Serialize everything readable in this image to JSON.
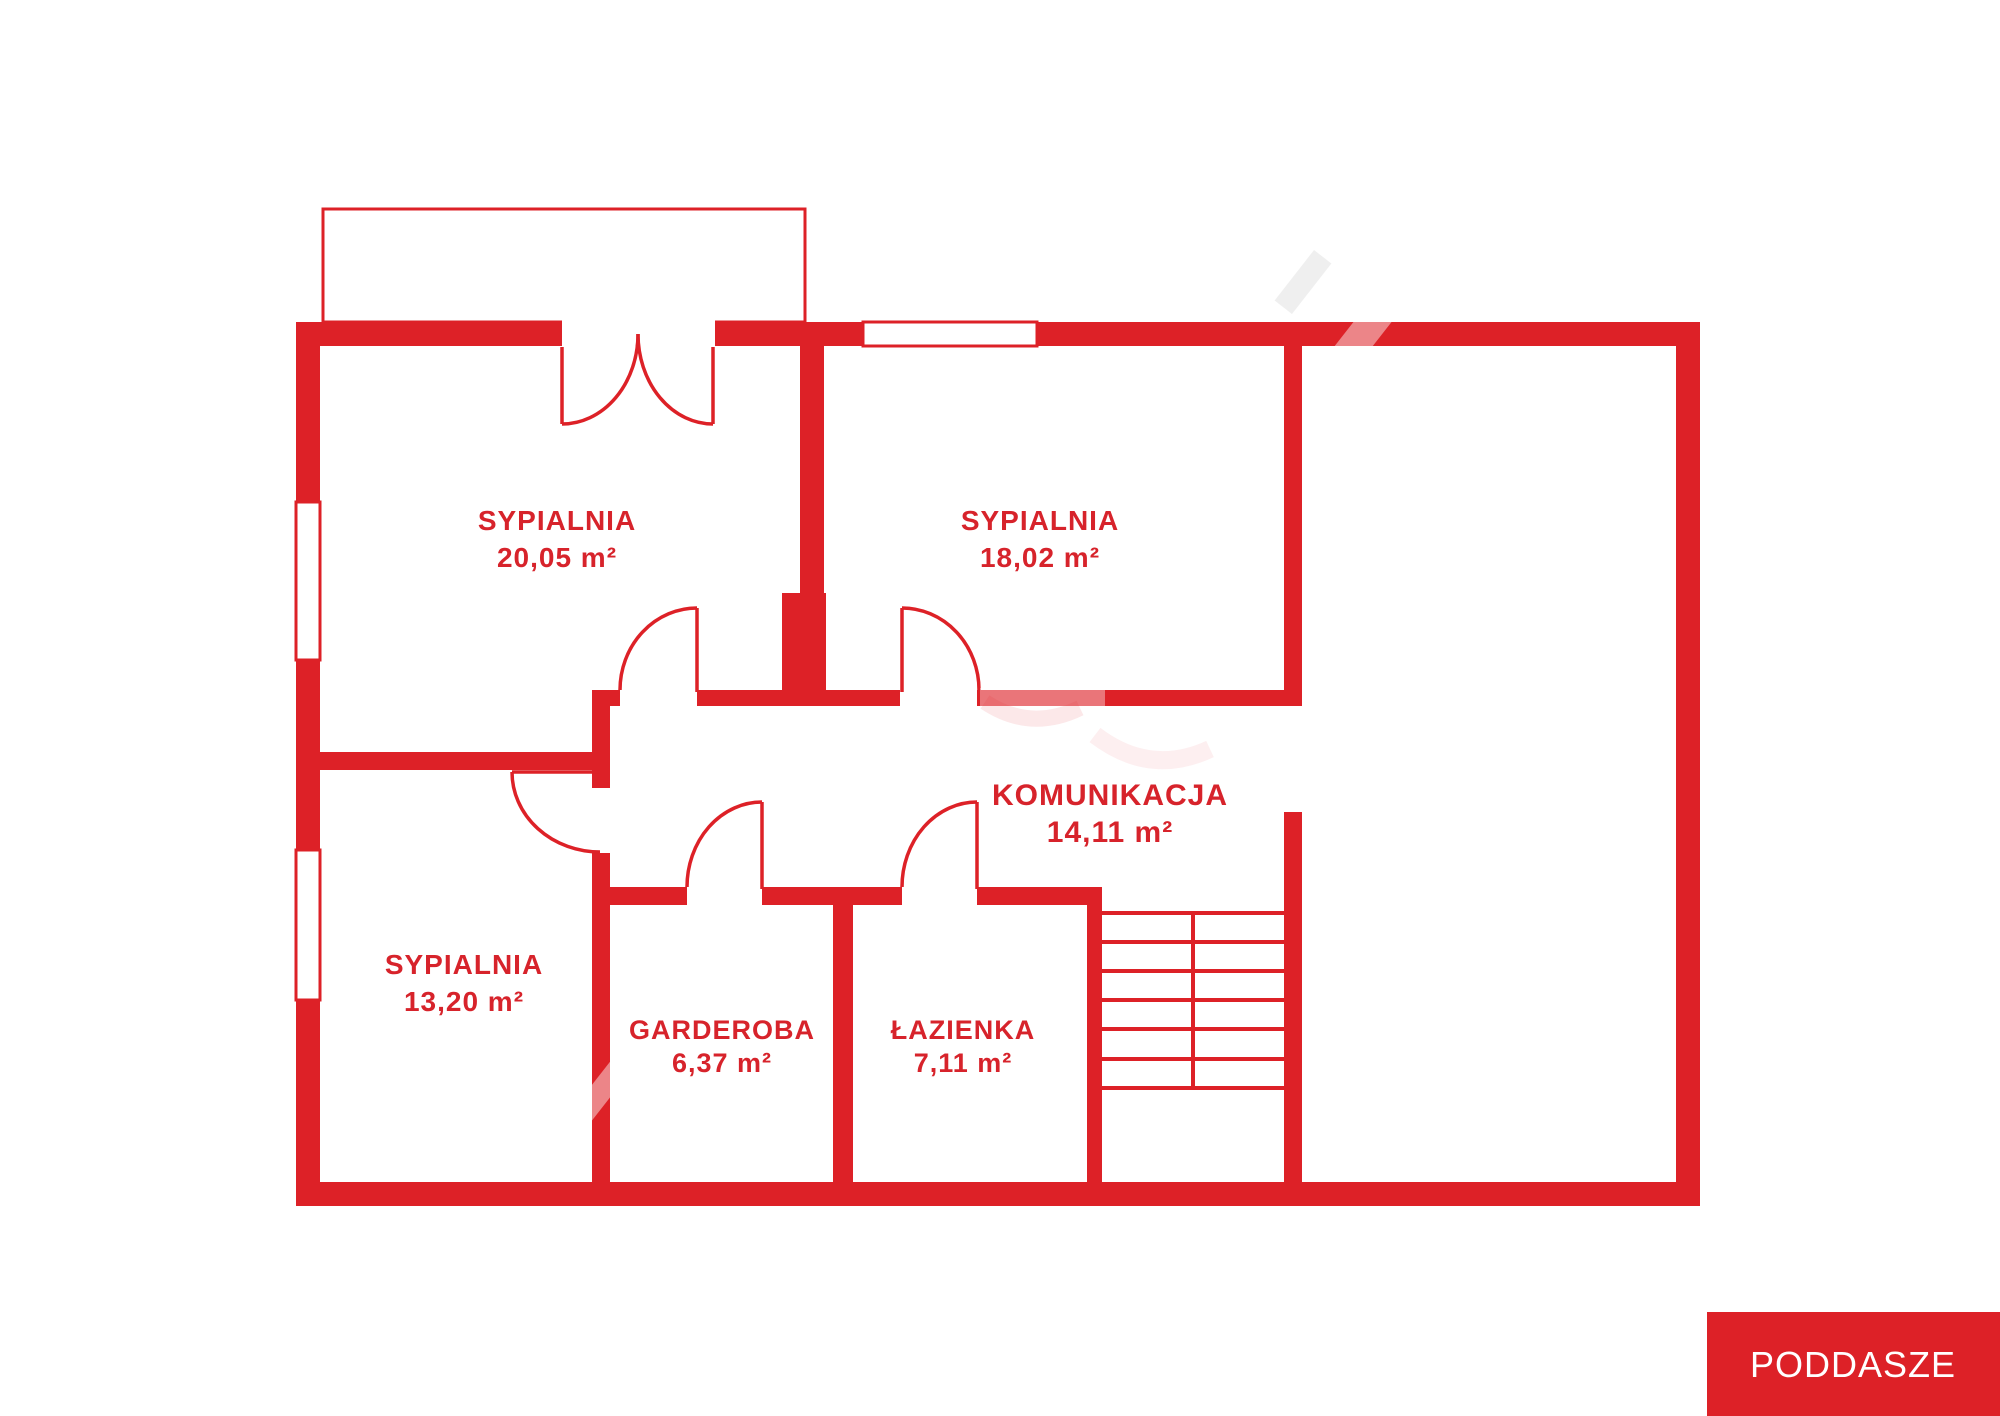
{
  "palette": {
    "accent_red": "#dd2127",
    "label_red": "#d7232b",
    "white": "#ffffff"
  },
  "rooms": [
    {
      "name": "SYPIALNIA",
      "area": "20,05 m²"
    },
    {
      "name": "SYPIALNIA",
      "area": "18,02 m²"
    },
    {
      "name": "KOMUNIKACJA",
      "area": "14,11 m²"
    },
    {
      "name": "SYPIALNIA",
      "area": "13,20 m²"
    },
    {
      "name": "GARDEROBA",
      "area": "6,37 m²"
    },
    {
      "name": "ŁAZIENKA",
      "area": "7,11 m²"
    }
  ],
  "legend": {
    "label": "PODDASZE"
  }
}
